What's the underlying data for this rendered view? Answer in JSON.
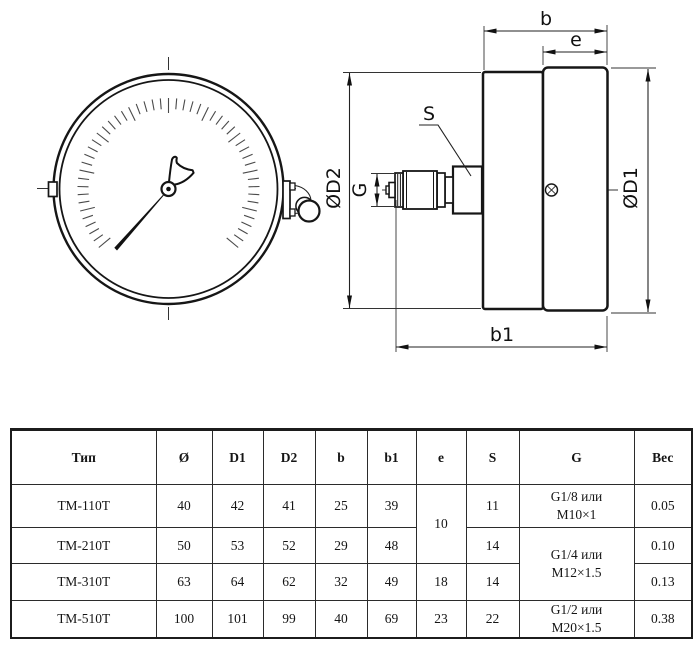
{
  "drawing": {
    "dim_labels": {
      "b": "b",
      "e": "e",
      "b1": "b1",
      "s": "S",
      "g": "G",
      "od1": "ØD1",
      "od2": "ØD2"
    }
  },
  "table": {
    "headers": {
      "type": "Тип",
      "diameter": "Ø",
      "d1": "D1",
      "d2": "D2",
      "b": "b",
      "b1": "b1",
      "e": "e",
      "s": "S",
      "g": "G",
      "weight": "Вес"
    },
    "rows": [
      {
        "type": "ТМ-110Т",
        "diameter": "40",
        "d1": "42",
        "d2": "41",
        "b": "25",
        "b1": "39",
        "e": "10",
        "s": "11",
        "g1": "G1/8 или",
        "g2": "М10×1",
        "weight": "0.05"
      },
      {
        "type": "ТМ-210Т",
        "diameter": "50",
        "d1": "53",
        "d2": "52",
        "b": "29",
        "b1": "48",
        "s": "14",
        "g1": "G1/4 или",
        "g2": "М12×1.5",
        "weight": "0.10"
      },
      {
        "type": "ТМ-310Т",
        "diameter": "63",
        "d1": "64",
        "d2": "62",
        "b": "32",
        "b1": "49",
        "e": "18",
        "s": "14",
        "weight": "0.13"
      },
      {
        "type": "ТМ-510Т",
        "diameter": "100",
        "d1": "101",
        "d2": "99",
        "b": "40",
        "b1": "69",
        "e": "23",
        "s": "22",
        "g1": "G1/2 или",
        "g2": "М20×1.5",
        "weight": "0.38"
      }
    ]
  }
}
